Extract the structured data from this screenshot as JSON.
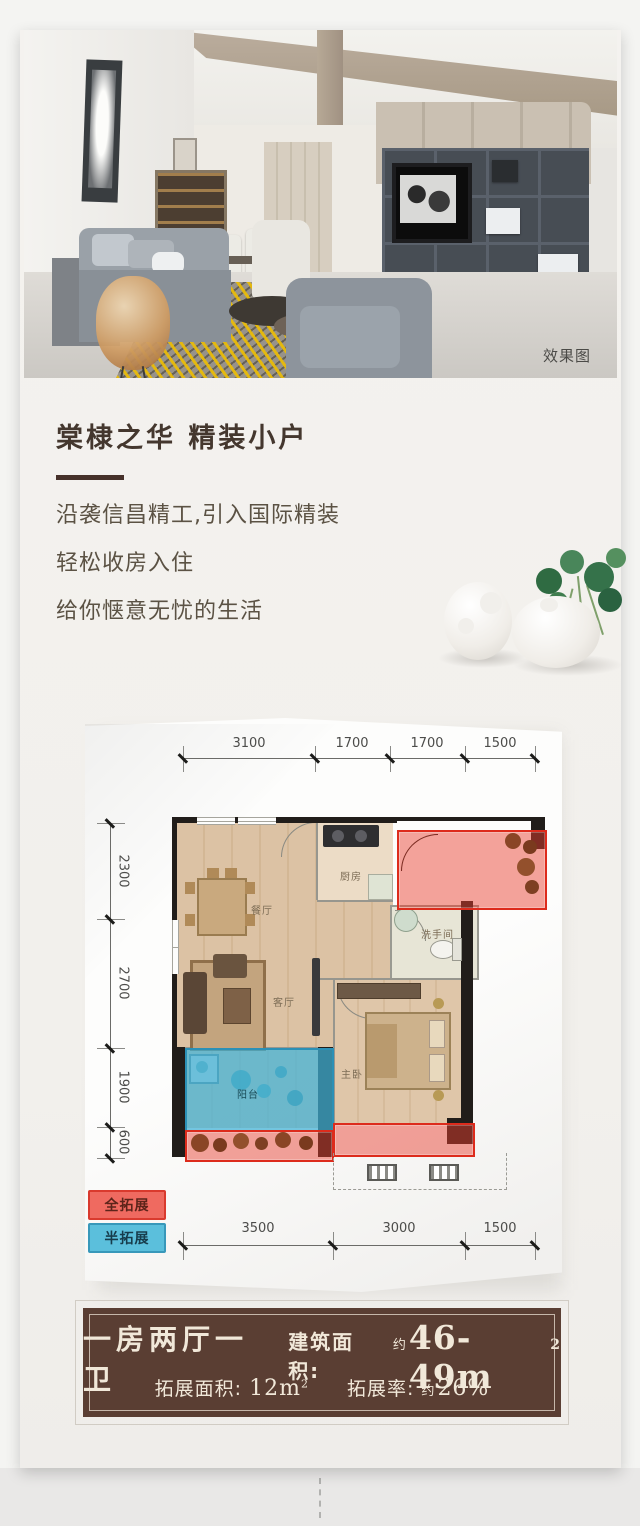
{
  "hero": {
    "watermark": "效果图"
  },
  "intro": {
    "title": "棠棣之华 精装小户",
    "lines": [
      "沿袭信昌精工,引入国际精装",
      "轻松收房入住",
      "给你惬意无忧的生活"
    ]
  },
  "floorplan": {
    "dims_top": [
      "3100",
      "1700",
      "1700",
      "1500"
    ],
    "dims_left": [
      "2300",
      "2700",
      "1900",
      "600"
    ],
    "dims_bottom": [
      "3500",
      "3000",
      "1500"
    ],
    "rooms": {
      "dining": "餐厅",
      "kitchen": "厨房",
      "bath": "洗手间",
      "living": "客厅",
      "master": "主卧",
      "balcony": "阳台"
    },
    "legend": {
      "full": "全拓展",
      "half": "半拓展"
    },
    "colors": {
      "full_expand": "#dd2b1c",
      "half_expand": "#3eb0d6"
    }
  },
  "banner": {
    "layout": "一房两厅一卫",
    "area_label": "建筑面积:",
    "area_approx": "约",
    "area_value": "46-49m",
    "area_sup": "2",
    "expand_label": "拓展面积:",
    "expand_value": "12m",
    "expand_sup": "2",
    "rate_label": "拓展率:",
    "rate_approx": "约",
    "rate_value": "26%",
    "bg_color": "#5a3e33"
  }
}
